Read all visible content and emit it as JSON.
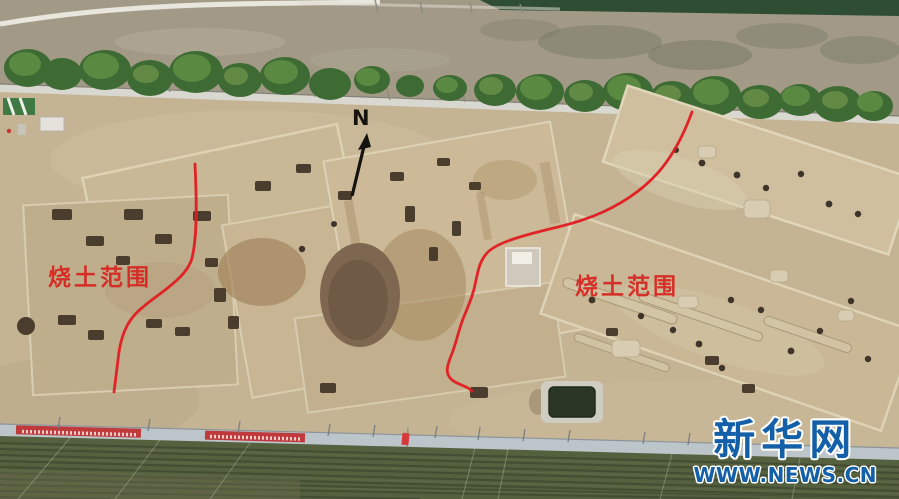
{
  "annotations": {
    "north_label": "N",
    "burnt_area_labels": [
      {
        "text": "烧土范围",
        "position": "west"
      },
      {
        "text": "烧土范围",
        "position": "east"
      }
    ],
    "annotation_color": "#d8241f"
  },
  "watermark": {
    "brand": "新华网",
    "url": "WWW.NEWS.CN",
    "color": "#1460a8"
  },
  "scene_colors": {
    "excavation_tan": "#c5b493",
    "road_gray": "#a09884",
    "tree_green": "#4a7a3a",
    "crop_field_green": "#55603f",
    "fence_gray": "#bcc5ca",
    "banner_red": "#c03a3c",
    "pond_green": "#2c3626"
  }
}
